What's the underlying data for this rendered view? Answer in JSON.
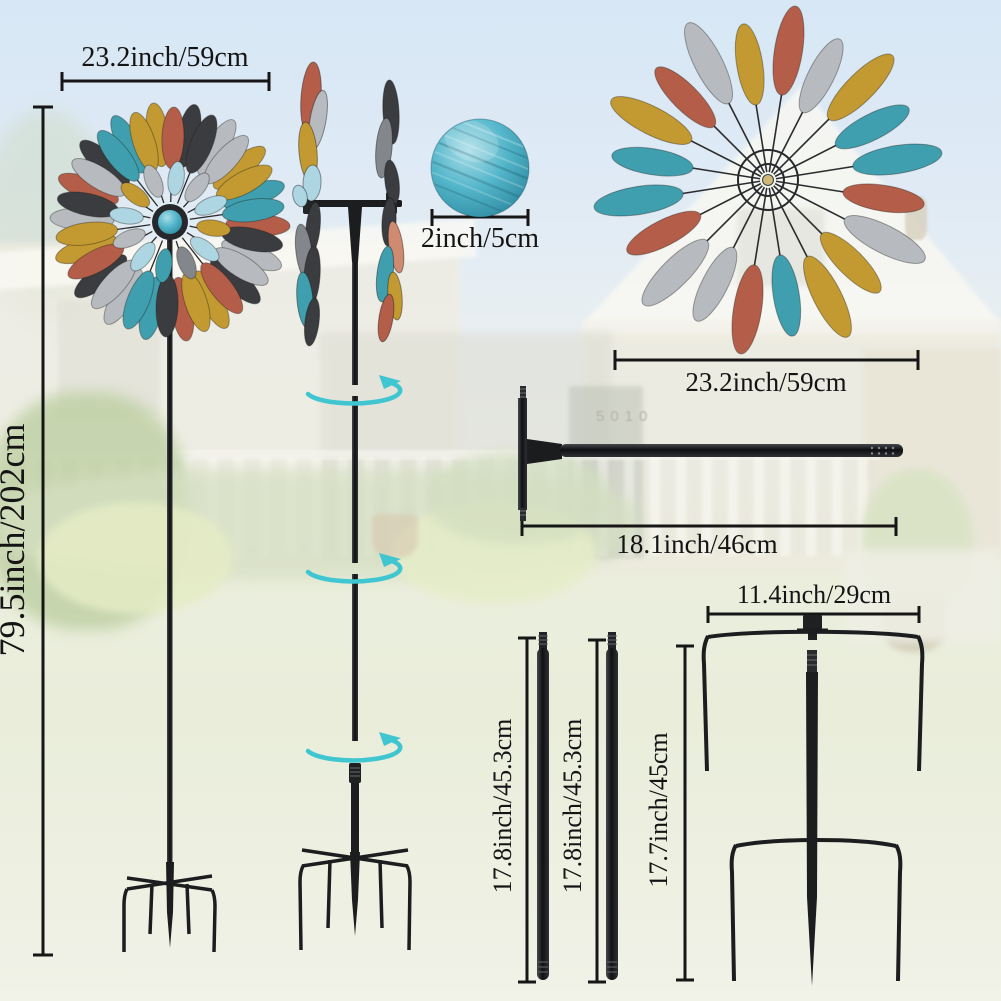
{
  "title": "Wind spinner product dimensions diagram",
  "background": {
    "house_number": "5010"
  },
  "measurements": {
    "spinner_width": "23.2inch/59cm",
    "total_height": "79.5inch/202cm",
    "ball_diameter": "2inch/5cm",
    "wheel_width": "23.2inch/59cm",
    "rod_length": "18.1inch/46cm",
    "stake_width": "11.4inch/29cm",
    "pole1_length": "17.8inch/45.3cm",
    "pole2_length": "17.8inch/45.3cm",
    "stake_height": "17.7inch/45cm"
  },
  "colors": {
    "measure_line": "#161616",
    "metal_dark": "#1c1d1f",
    "accent_teal": "#3fc6d0",
    "ball_teal": "#4fb3c9"
  },
  "graphics": {
    "palette": {
      "copper": "#b45e4a",
      "copper_light": "#cf8a70",
      "gold": "#c39a31",
      "silver": "#b7bbc0",
      "silver_dark": "#83878c",
      "teal": "#3f9fae",
      "black": "#3a3c40",
      "paleblue": "#aed6e2"
    },
    "accent": "#3fc6d0",
    "spinners": [
      {
        "id": "leftSpinner",
        "cx": 170,
        "cy": 222,
        "spokes": {
          "count": 18,
          "offset": 2,
          "r1": 20,
          "r2": 112,
          "w": 1.3
        },
        "rings": [
          {
            "count": 18,
            "offset": 12,
            "r": 88,
            "rx": 11,
            "ry": 32,
            "colors": [
              "black",
              "silver",
              "gold",
              "teal",
              "copper",
              "silver",
              "black",
              "gold",
              "copper",
              "teal",
              "silver",
              "black",
              "gold",
              "silver",
              "copper",
              "black",
              "teal",
              "gold"
            ]
          },
          {
            "count": 18,
            "offset": 2,
            "r": 84,
            "rx": 11,
            "ry": 31,
            "colors": [
              "copper",
              "black",
              "silver",
              "gold",
              "teal",
              "black",
              "silver",
              "copper",
              "gold",
              "black",
              "teal",
              "silver",
              "copper",
              "gold",
              "black",
              "silver",
              "teal",
              "gold"
            ]
          },
          {
            "count": 12,
            "offset": 8,
            "r": 44,
            "rx": 8,
            "ry": 17,
            "colors": [
              "paleblue",
              "silver",
              "paleblue",
              "gold",
              "paleblue",
              "silver_dark",
              "teal",
              "paleblue",
              "silver",
              "paleblue",
              "gold",
              "silver"
            ]
          }
        ],
        "hub": [
          {
            "r": 18,
            "fill": "#26282b"
          },
          {
            "r": 12,
            "fill": "ballGrad"
          }
        ]
      },
      {
        "id": "rightSpinner",
        "cx": 768,
        "cy": 180,
        "spokes": {
          "count": 20,
          "offset": 9,
          "r1": 8,
          "r2": 88,
          "w": 1.6
        },
        "rings": [
          {
            "count": 10,
            "offset": 9,
            "r": 131,
            "rx": 14,
            "ry": 45,
            "colors": [
              "copper",
              "gold",
              "teal",
              "silver",
              "gold",
              "copper",
              "silver",
              "teal",
              "gold",
              "silver"
            ]
          },
          {
            "count": 10,
            "offset": 27,
            "r": 117,
            "rx": 13,
            "ry": 41,
            "colors": [
              "silver",
              "teal",
              "copper",
              "gold",
              "teal",
              "silver",
              "copper",
              "teal",
              "copper",
              "gold"
            ]
          }
        ],
        "hub": [
          {
            "r": 30,
            "stroke": "#26282b",
            "sw": 2
          },
          {
            "r": 16,
            "stroke": "#26282b",
            "sw": 2
          },
          {
            "r": 5.5,
            "fill": "#cdb87a",
            "stroke": "#3a3c40",
            "sw": 1
          }
        ]
      }
    ],
    "side_blades": [
      [
        311,
        98,
        10,
        36,
        4,
        "copper"
      ],
      [
        318,
        120,
        8,
        30,
        10,
        "silver"
      ],
      [
        308,
        152,
        9,
        30,
        -5,
        "gold"
      ],
      [
        312,
        183,
        9,
        18,
        3,
        "paleblue"
      ],
      [
        300,
        196,
        7,
        11,
        -15,
        "paleblue"
      ],
      [
        313,
        228,
        7,
        26,
        6,
        "black"
      ],
      [
        304,
        252,
        8,
        28,
        -7,
        "silver_dark"
      ],
      [
        312,
        276,
        8,
        30,
        4,
        "black"
      ],
      [
        305,
        300,
        8,
        28,
        -5,
        "teal"
      ],
      [
        312,
        322,
        7,
        24,
        7,
        "black"
      ],
      [
        391,
        112,
        8,
        32,
        -3,
        "black"
      ],
      [
        384,
        148,
        8,
        30,
        5,
        "silver_dark"
      ],
      [
        392,
        182,
        7,
        22,
        -7,
        "black"
      ],
      [
        389,
        222,
        7,
        24,
        3,
        "black"
      ],
      [
        396,
        247,
        7,
        26,
        -8,
        "copper_light"
      ],
      [
        385,
        274,
        8,
        28,
        7,
        "teal"
      ],
      [
        395,
        296,
        7,
        24,
        -5,
        "gold"
      ],
      [
        386,
        318,
        7,
        24,
        9,
        "copper"
      ]
    ],
    "rotation_arrows": [
      [
        355,
        391
      ],
      [
        355,
        569
      ],
      [
        355,
        748
      ]
    ]
  }
}
